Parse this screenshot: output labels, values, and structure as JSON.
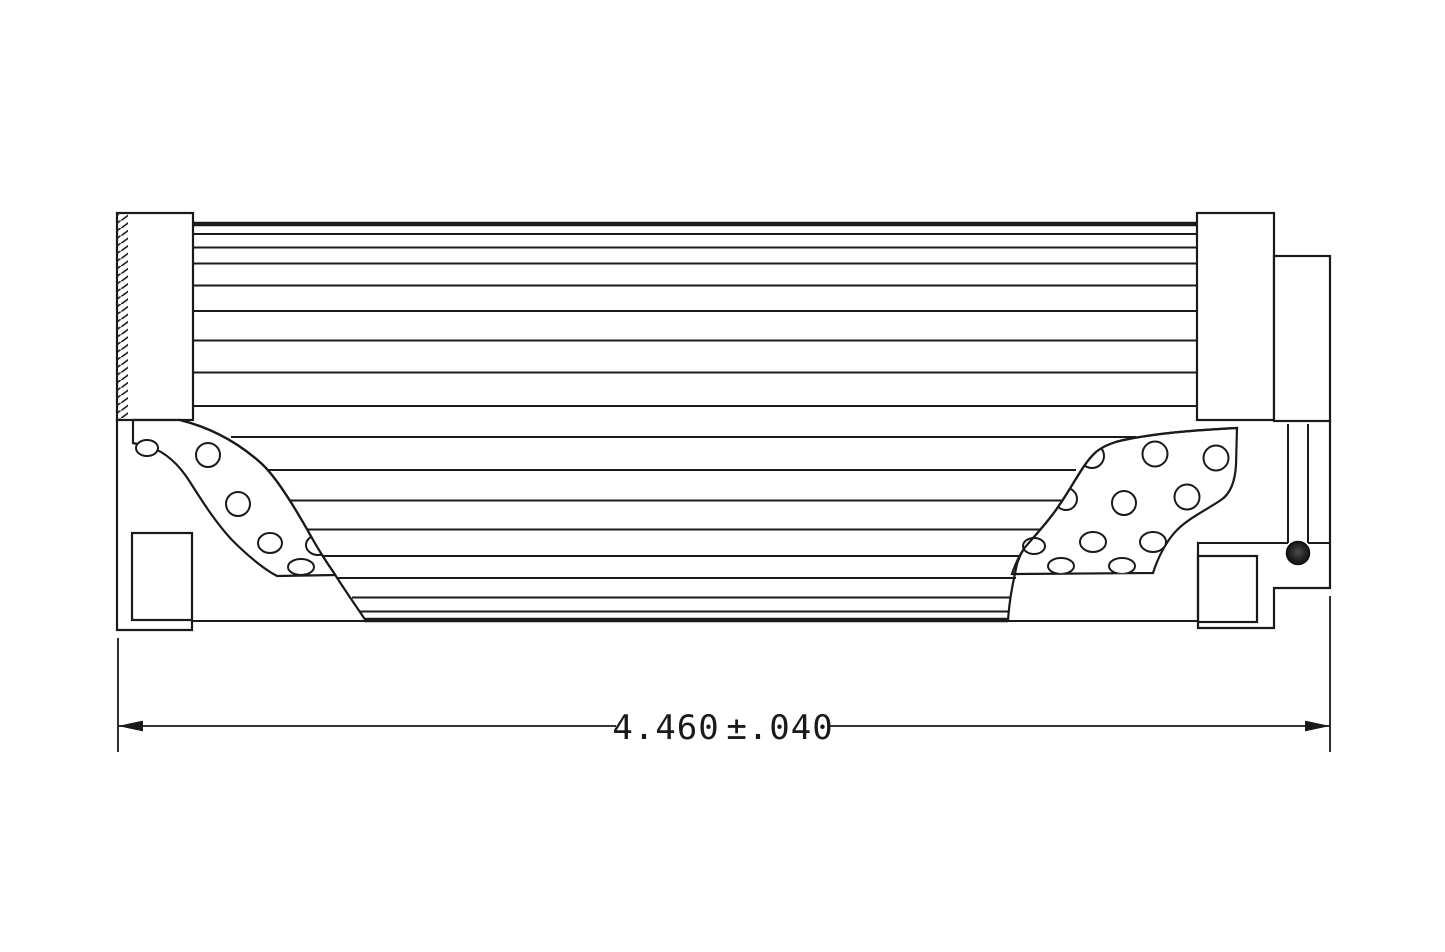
{
  "page": {
    "background": "#ffffff",
    "line_color": "#1a1a1a",
    "o_ring_color": "#1f1f1f"
  },
  "dimension": {
    "value": "4.460",
    "tolerance": "±.040",
    "full_label": "4.460 ±.040"
  }
}
